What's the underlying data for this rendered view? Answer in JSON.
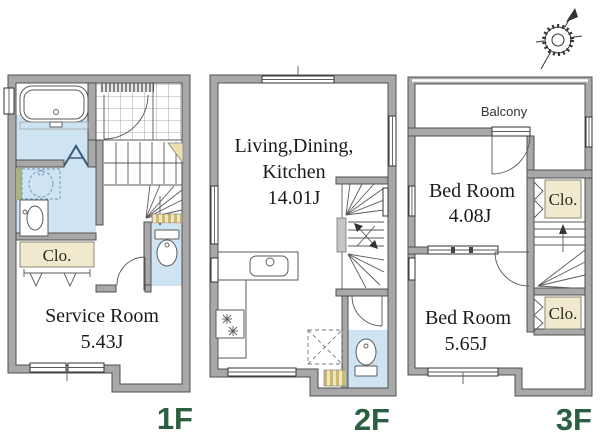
{
  "compass": {
    "icon": "compass-rose"
  },
  "colors": {
    "wall": "#a8a8a8",
    "wet_area": "#cfe4f3",
    "closet": "#f0e9cd",
    "floor_label": "#2a5f41",
    "stripe_tan": "#cdb96e"
  },
  "floors": [
    {
      "id": "1f",
      "label": "1F",
      "closets": [
        {
          "label": "Clo."
        }
      ],
      "rooms": [
        {
          "name": "Service Room",
          "area": "5.43J"
        }
      ]
    },
    {
      "id": "2f",
      "label": "2F",
      "rooms": [
        {
          "name_line1": "Living,Dining,",
          "name_line2": "Kitchen",
          "area": "14.01J"
        }
      ]
    },
    {
      "id": "3f",
      "label": "3F",
      "balcony_label": "Balcony",
      "closets": [
        {
          "label": "Clo."
        },
        {
          "label": "Clo."
        }
      ],
      "rooms": [
        {
          "name": "Bed Room",
          "area": "4.08J"
        },
        {
          "name": "Bed Room",
          "area": "5.65J"
        }
      ]
    }
  ]
}
